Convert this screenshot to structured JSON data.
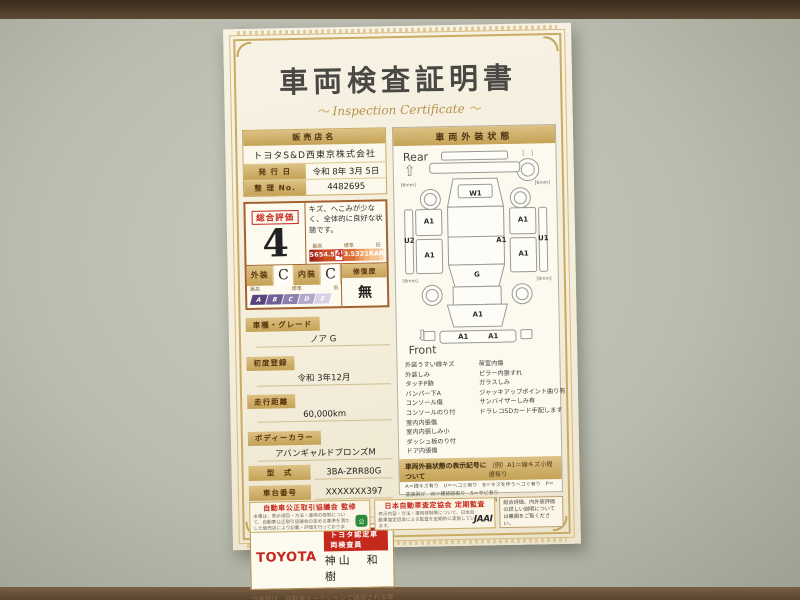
{
  "certificate": {
    "title": "車両検査証明書",
    "subtitle": "Inspection Certificate",
    "dealer": {
      "header": "販売店名",
      "name": "トヨタS&D西東京株式会社",
      "issue_label": "発 行 日",
      "issue_value": "令和 8年 3月 5日",
      "serial_label": "整 理 No.",
      "serial_value": "4482695"
    },
    "rating": {
      "label": "総合評価",
      "score": "4",
      "comment": "キズ、へこみが少なく、全体的に良好な状態です。",
      "scale_high": "最高",
      "scale_mid": "標準",
      "scale_low": "低",
      "score_scale": [
        "S",
        "6",
        "5",
        "4.5",
        "4",
        "3.5",
        "3",
        "2",
        "1",
        "RA",
        "R"
      ],
      "exterior_label": "外装",
      "exterior_grade": "C",
      "interior_label": "内装",
      "interior_grade": "C",
      "grade_scale": [
        "A",
        "B",
        "C",
        "D",
        "E"
      ],
      "repair_label": "修復歴",
      "repair_value": "無"
    },
    "details": [
      {
        "label": "車種・グレード",
        "value": "ノア G"
      },
      {
        "label": "初度登録",
        "value": "令和 3年12月"
      },
      {
        "label": "走行距離",
        "value": "60,000km"
      },
      {
        "label": "ボディーカラー",
        "value": "アバンギャルドブロンズM"
      },
      {
        "label": "型　式",
        "value": "3BA-ZRR80G"
      },
      {
        "label": "車台番号",
        "value": "XXXXXXX397"
      },
      {
        "label": "エンジン",
        "value": "ガソリン"
      }
    ],
    "inspector": {
      "brand": "TOYOTA",
      "badge": "トヨタ認定車両検査員",
      "name": "神山　和樹"
    },
    "disclaimer": "当車両は、自動車オークションで通用される車両評価基準に沿い、トヨタユーゼックが認定した検査員が厳正に検査・評価いたしました。",
    "exterior": {
      "header": "車両外装状態",
      "rear_label": "Rear",
      "front_label": "Front",
      "spare_bracket": "[　]",
      "markers": {
        "back_door": "W1",
        "left_quarter": "A1",
        "left_door": "A1",
        "left_rocker": "U2",
        "right_quarter": "A1",
        "right_door": "A1",
        "right_front_door": "A1",
        "right_rocker": "U1",
        "windshield": "G",
        "front_bumper": "A1",
        "front_lower_left": "A1",
        "front_lower_right": "A1",
        "tire_tread": "6mm"
      },
      "legend_left": [
        "外装うすい線キズ",
        "外装しみ",
        "タッチP跡",
        "バンパー下A",
        "コンソール傷",
        "コンソールのり付",
        "室内内張傷",
        "室内内張しみ小",
        "ダッシュ板のり付",
        "ドア内張傷"
      ],
      "legend_right": [
        "荷室内傷",
        "ピラー内張すれ",
        "ガラスしみ",
        "ジャッキアップポイント曲り有",
        "サンバイザーしみ有",
        "ドラレコSDカード手配します"
      ],
      "symbols_title": "車両外装状態の表示記号について",
      "symbols_example": "（例）A1＝線キズ小程度有り",
      "symbols_lines": [
        "A＝線キズ有り　U＝ヘコミ有り　B＝キズを伴うヘコミ有り　P＝塗装剥げ　W＝補修跡有り　S＝サビ有り",
        "C＝腐食有り　G＝フロントガラスキズ有り　X＝要交換（裏面に補足有り）　XX＝交換歴有り",
        "1＝小程度　2＝中程度　3＝中程度以上　※タイヤ横の数字は、残り溝を示しています。"
      ]
    },
    "footer": {
      "fair_trade_title": "自動車公正取引協議会 監修",
      "fair_trade_body": "本書は、表示項目・方法・運用の体制について、自動車公正取引協議会の定める基準を満たした販売店により記載・評価を行っております。",
      "fair_trade_logo": "公",
      "jaai_title": "日本自動車査定協会 定期監査",
      "jaai_body": "表示内容・方法・運用体制等について、日本自動車査定協会による監査を定期的に実施しています。",
      "jaai_logo": "JAAI",
      "back_note": "総合評価、内外装評価の詳しい説明については裏面をご覧ください。"
    }
  }
}
